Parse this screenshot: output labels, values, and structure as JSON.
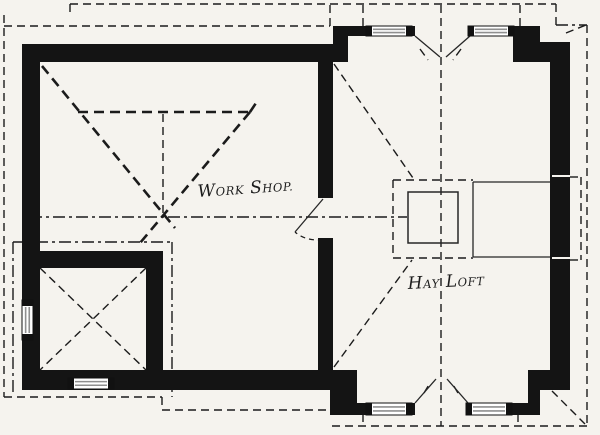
{
  "figure": {
    "type": "architectural-floor-plan",
    "title": "Loft plan with Work Shop and Hay Loft",
    "background": "#f5f3ee",
    "ink": "#1b1b1b",
    "wall_color": "#141414",
    "window_stripe_color": "#8f8f8f"
  },
  "labels": {
    "workshop": "Work Shop.",
    "hayloft": "Hay Loft"
  },
  "rooms": [
    {
      "name": "Work Shop.",
      "position": "left"
    },
    {
      "name": "Hay Loft",
      "position": "right"
    },
    {
      "name": "small corner room",
      "position": "bottom-left"
    }
  ],
  "plan": {
    "width": 600,
    "height": 435,
    "walls": [
      [
        22,
        44,
        326,
        18
      ],
      [
        22,
        44,
        18,
        344
      ],
      [
        22,
        251,
        141,
        17
      ],
      [
        146,
        251,
        17,
        137
      ],
      [
        22,
        370,
        335,
        20
      ],
      [
        318,
        62,
        15,
        136
      ],
      [
        318,
        238,
        15,
        133
      ],
      [
        333,
        26,
        15,
        36
      ],
      [
        333,
        26,
        82,
        10
      ],
      [
        468,
        26,
        72,
        10
      ],
      [
        513,
        26,
        27,
        36
      ],
      [
        540,
        42,
        30,
        20
      ],
      [
        550,
        42,
        20,
        348
      ],
      [
        528,
        370,
        42,
        20
      ],
      [
        528,
        370,
        12,
        45
      ],
      [
        345,
        403,
        70,
        12
      ],
      [
        466,
        403,
        74,
        12
      ],
      [
        330,
        370,
        27,
        45
      ]
    ],
    "windows": [
      {
        "x": 366,
        "y": 26,
        "w": 46,
        "h": 10,
        "o": "h"
      },
      {
        "x": 468,
        "y": 26,
        "w": 46,
        "h": 10,
        "o": "h"
      },
      {
        "x": 366,
        "y": 403,
        "w": 46,
        "h": 12,
        "o": "h"
      },
      {
        "x": 466,
        "y": 403,
        "w": 46,
        "h": 12,
        "o": "h"
      },
      {
        "x": 68,
        "y": 378,
        "w": 46,
        "h": 11,
        "o": "h"
      },
      {
        "x": 22,
        "y": 300,
        "w": 11,
        "h": 40,
        "o": "v"
      }
    ],
    "white_slits": [
      [
        552,
        176,
        570,
        176
      ],
      [
        552,
        258,
        570,
        258
      ]
    ],
    "solid_lines": [
      [
        415,
        36,
        440,
        57
      ],
      [
        470,
        36,
        446,
        57
      ],
      [
        415,
        403,
        436,
        379
      ],
      [
        468,
        403,
        447,
        379
      ],
      [
        323,
        199,
        295,
        232
      ],
      [
        473,
        182,
        550,
        182
      ],
      [
        473,
        257,
        550,
        257
      ],
      [
        473,
        182,
        473,
        257
      ]
    ],
    "square": {
      "x": 408,
      "y": 192,
      "w": 50,
      "h": 51
    },
    "dashed_lines": [
      [
        "d",
        70,
        4,
        556,
        4
      ],
      [
        "d",
        70,
        4,
        70,
        15
      ],
      [
        "d",
        4,
        26,
        330,
        26
      ],
      [
        "d",
        4,
        15,
        4,
        397
      ],
      [
        "d",
        4,
        397,
        162,
        397
      ],
      [
        "d",
        162,
        397,
        162,
        410
      ],
      [
        "d",
        162,
        410,
        344,
        410
      ],
      [
        "d",
        332,
        426,
        587,
        426
      ],
      [
        "dd",
        13,
        242,
        13,
        396
      ],
      [
        "dd",
        13,
        242,
        172,
        242
      ],
      [
        "dd",
        172,
        242,
        172,
        397
      ],
      [
        "d",
        330,
        5,
        330,
        26
      ],
      [
        "d",
        556,
        4,
        556,
        25
      ],
      [
        "dd",
        556,
        25,
        587,
        25
      ],
      [
        "d",
        587,
        25,
        587,
        426
      ],
      [
        "d",
        363,
        5,
        363,
        26
      ],
      [
        "d",
        520,
        5,
        520,
        26
      ],
      [
        "d",
        363,
        414,
        363,
        426
      ],
      [
        "d",
        518,
        414,
        518,
        426
      ],
      [
        "d",
        441,
        5,
        441,
        426
      ],
      [
        "dd",
        30,
        217,
        407,
        217
      ],
      [
        "d",
        334,
        64,
        413,
        178
      ],
      [
        "d",
        334,
        367,
        412,
        260
      ],
      [
        "d",
        393,
        180,
        473,
        180
      ],
      [
        "d",
        393,
        258,
        473,
        258
      ],
      [
        "d",
        393,
        180,
        393,
        258
      ],
      [
        "d",
        570,
        177,
        581,
        177
      ],
      [
        "d",
        581,
        177,
        581,
        260
      ],
      [
        "d",
        570,
        260,
        581,
        260
      ],
      [
        "d",
        566,
        33,
        586,
        25
      ],
      [
        "d",
        552,
        391,
        585,
        424
      ],
      [
        "d",
        40,
        268,
        146,
        370
      ],
      [
        "d",
        146,
        268,
        40,
        370
      ],
      [
        "d",
        420,
        49,
        428,
        60
      ],
      [
        "d",
        461,
        49,
        453,
        60
      ],
      [
        "d",
        424,
        393,
        430,
        383
      ],
      [
        "d",
        458,
        393,
        452,
        383
      ],
      [
        "d",
        163,
        114,
        163,
        214
      ]
    ],
    "bold_dashed": [
      [
        78,
        112,
        250,
        112
      ],
      [
        250,
        112,
        256,
        103
      ],
      [
        42,
        66,
        175,
        228
      ],
      [
        250,
        112,
        140,
        243
      ]
    ],
    "arcs": [
      {
        "d": "M323,240 Q305,241 295,232"
      }
    ],
    "label_layout": [
      {
        "key": "workshop",
        "x": 198,
        "y": 197,
        "rot": -4
      },
      {
        "key": "hayloft",
        "x": 408,
        "y": 289,
        "rot": -3
      }
    ]
  }
}
